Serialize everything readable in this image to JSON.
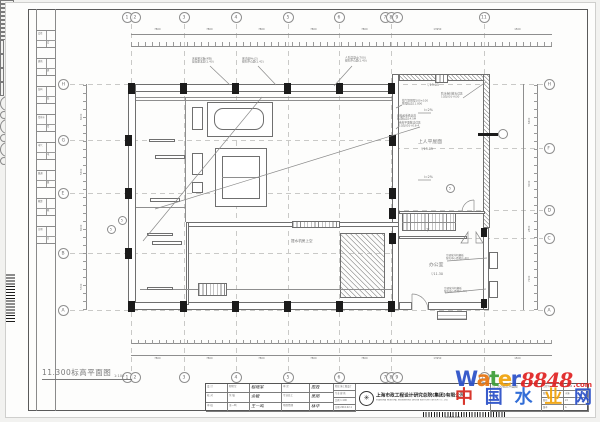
{
  "sheet": {
    "drawing_title": "11.300标高平面图",
    "drawing_scale": "1:100"
  },
  "grid": {
    "top": [
      "1",
      "2",
      "3",
      "4",
      "5",
      "6",
      "7",
      "8",
      "9",
      "11"
    ],
    "left": [
      "H",
      "G",
      "E",
      "B",
      "A"
    ],
    "right": [
      "H",
      "F",
      "D",
      "C",
      "A"
    ]
  },
  "rooms": {
    "roof": "上人平屋面",
    "office": "办公室",
    "pump_hall": "提水机房上空",
    "down": "下"
  },
  "marks": {
    "slope": "i=2%",
    "elev_roof_edge": "▽13.05",
    "elev_roof_mid": "▽13.05",
    "elev_office": "▽11.30",
    "detail_no": "5"
  },
  "annotations": {
    "top": [
      [
        "天窗采光板(4块)",
        "窗台距本层(1.40)"
      ],
      [
        "采光窗Mc(2)",
        "留孔中心距(1.42)"
      ],
      [
        "人孔混凝土(700)",
        "留孔中心距(1.40)"
      ]
    ],
    "roof": [
      [
        "排气管预埋100×100",
        "预埋标高11.800"
      ],
      [
        "卷材平面做法详见",
        "10ZJ001-A16-4"
      ],
      [
        "防水卷材收头详见",
        "10ZJ001-A/30"
      ]
    ],
    "crane": [
      "悬挂起重机轨道",
      "轨顶标高14.5M"
    ],
    "ac": [
      [
        "空调室外机搁板",
        "留孔中心距地(1.40)"
      ],
      [
        "空调室外机搁板",
        "留孔中心距地(1.40)"
      ]
    ]
  },
  "dimensions": {
    "top_totals": [
      "7800",
      "7800",
      "7800",
      "7800",
      "7800",
      "13950",
      "1500"
    ],
    "bottom_totals": [
      "7800",
      "7800",
      "7800",
      "7800",
      "7800",
      "13950",
      "1500"
    ],
    "left_totals": [
      "6000",
      "5300",
      "6000",
      "5700"
    ],
    "right_totals": [
      "6400",
      "3000",
      "2800",
      "7200"
    ]
  },
  "edge_strip": [
    "会签",
    "建筑",
    "结构",
    "给排水",
    "电气",
    "暖通",
    "概算",
    "日期"
  ],
  "title_block": {
    "sign_rows_a": [
      {
        "label": "设 计",
        "name": "程晓军",
        "sig": "程晓军"
      },
      {
        "label": "校 对",
        "name": "余 敏",
        "sig": "余敏"
      },
      {
        "label": "审 核",
        "name": "王一鸣",
        "sig": "王一鸣"
      }
    ],
    "sign_rows_b": [
      {
        "label": "审 定",
        "sig": "周政"
      },
      {
        "label": "专业总工",
        "sig": "吴刚"
      },
      {
        "label": "项目经理",
        "sig": "林华"
      }
    ],
    "stage_rows": [
      {
        "label": "阶段",
        "value": "施工图设计"
      },
      {
        "label": "专业",
        "value": "建 筑"
      },
      {
        "label": "比例",
        "value": "1:100"
      },
      {
        "label": "日期",
        "value": "2010.02.1"
      }
    ],
    "company_cn": "上海市政工程设计研究总院(集团)有限公司",
    "company_en": "SHANGHAI MUNICIPAL ENGINEERING DESIGN INSTITUTE (GROUP) CO., LTD.",
    "drawing_name_cell": "11.300标高平面图",
    "right_fields": [
      {
        "label": "工程号",
        "value": "10264"
      },
      {
        "label": "图别",
        "value": "水施"
      },
      {
        "label": "图号",
        "value": "22"
      },
      {
        "label": "版本",
        "value": "A"
      }
    ]
  },
  "watermark": {
    "word": [
      {
        "ch": "W",
        "color": "#2b50c8"
      },
      {
        "ch": "a",
        "color": "#e87511"
      },
      {
        "ch": "t",
        "color": "#3d9e38"
      },
      {
        "ch": "e",
        "color": "#f0a20a"
      },
      {
        "ch": "r",
        "color": "#2b50c8"
      }
    ],
    "number": "8848",
    "number_color": "#e02222",
    "com": ".com",
    "cn": [
      {
        "ch": "中",
        "color": "#d6281e"
      },
      {
        "ch": "国",
        "color": "#2b50c8"
      },
      {
        "ch": "水",
        "color": "#2464d4"
      },
      {
        "ch": "业",
        "color": "#f0a20a"
      },
      {
        "ch": "网",
        "color": "#2b50c8"
      }
    ]
  },
  "barcodes": {
    "bottom_number": "04901081"
  }
}
